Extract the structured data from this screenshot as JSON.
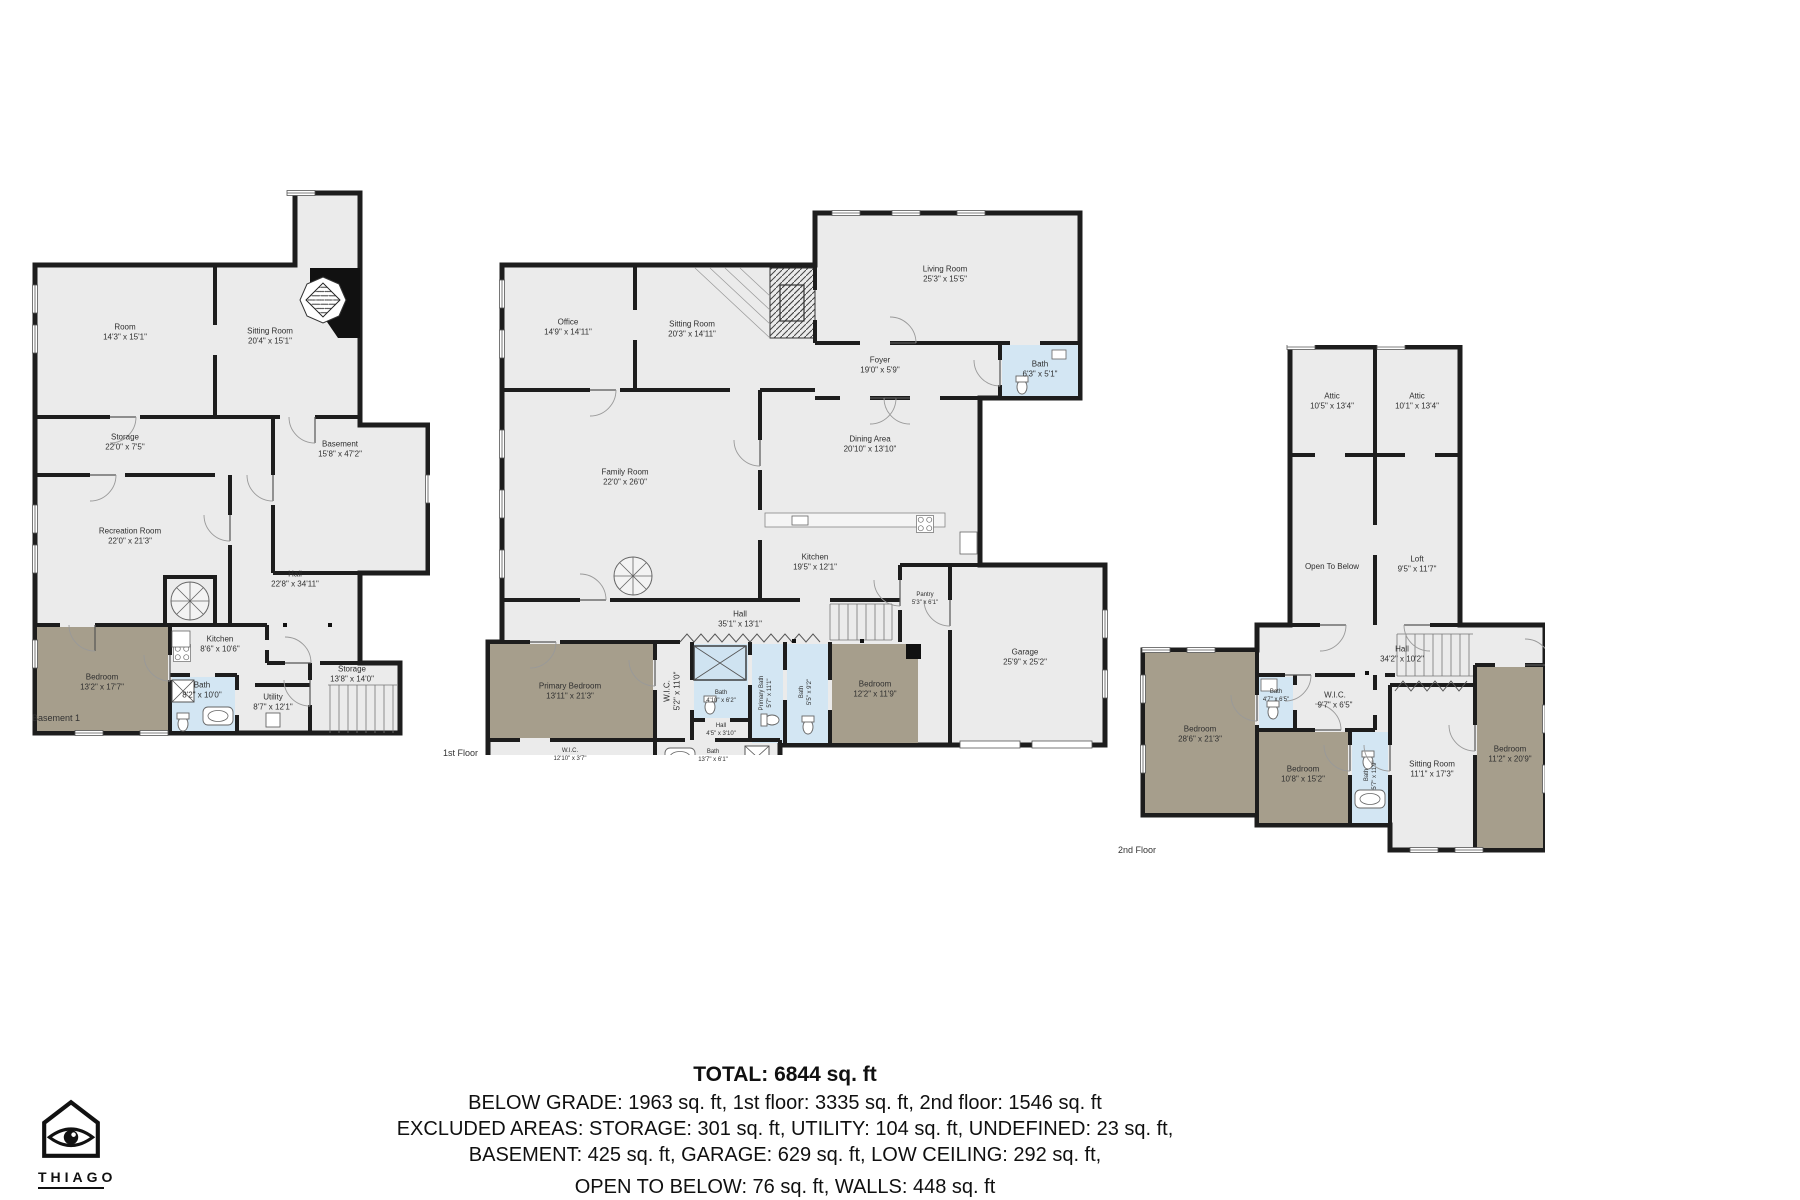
{
  "colors": {
    "floor": "#ebebeb",
    "wall": "#1d1d1d",
    "bedroom": "#a69e8c",
    "bath": "#d3e6f3"
  },
  "plans": [
    {
      "floor_label": "Basement 1",
      "rooms": [
        {
          "name": "Room",
          "dims": "14'3\" x 15'1\""
        },
        {
          "name": "Sitting Room",
          "dims": "20'4\" x 15'1\""
        },
        {
          "name": "Storage",
          "dims": "22'0\" x 7'5\""
        },
        {
          "name": "Basement",
          "dims": "15'8\" x 47'2\""
        },
        {
          "name": "Recreation Room",
          "dims": "22'0\" x 21'3\""
        },
        {
          "name": "Hall",
          "dims": "22'8\" x 34'11\""
        },
        {
          "name": "Bedroom",
          "dims": "13'2\" x 17'7\""
        },
        {
          "name": "Kitchen",
          "dims": "8'6\" x 10'6\""
        },
        {
          "name": "Bath",
          "dims": "8'2\" x 10'0\""
        },
        {
          "name": "Utility",
          "dims": "8'7\" x 12'1\""
        },
        {
          "name": "Storage",
          "dims": "13'8\" x 14'0\""
        }
      ]
    },
    {
      "floor_label": "1st Floor",
      "rooms": [
        {
          "name": "Office",
          "dims": "14'9\" x 14'11\""
        },
        {
          "name": "Sitting Room",
          "dims": "20'3\" x 14'11\""
        },
        {
          "name": "Living Room",
          "dims": "25'3\" x 15'5\""
        },
        {
          "name": "Foyer",
          "dims": "19'0\" x 5'9\""
        },
        {
          "name": "Bath",
          "dims": "6'3\" x 5'1\""
        },
        {
          "name": "Family Room",
          "dims": "22'0\" x 26'0\""
        },
        {
          "name": "Dining Area",
          "dims": "20'10\" x 13'10\""
        },
        {
          "name": "Kitchen",
          "dims": "19'5\" x 12'1\""
        },
        {
          "name": "Hall",
          "dims": "35'1\" x 13'1\""
        },
        {
          "name": "Pantry",
          "dims": "5'3\" x 6'1\""
        },
        {
          "name": "Primary Bedroom",
          "dims": "13'11\" x 21'3\""
        },
        {
          "name": "W.I.C.",
          "dims": "5'2\" x 11'0\""
        },
        {
          "name": "Bath",
          "dims": "4'10\" x 6'2\""
        },
        {
          "name": "Bath",
          "dims": "5'5\" x 9'2\""
        },
        {
          "name": "Hall",
          "dims": "4'5\" x 3'10\""
        },
        {
          "name": "Primary Bath",
          "dims": "5'7\" x 11'1\""
        },
        {
          "name": "W.I.C.",
          "dims": "12'10\" x 3'7\""
        },
        {
          "name": "Bath",
          "dims": "13'7\" x 6'1\""
        },
        {
          "name": "Bedroom",
          "dims": "12'2\" x 11'9\""
        },
        {
          "name": "Garage",
          "dims": "25'9\" x 25'2\""
        }
      ]
    },
    {
      "floor_label": "2n‌d Floor",
      "rooms": [
        {
          "name": "Attic",
          "dims": "10'5\" x 13'4\""
        },
        {
          "name": "Attic",
          "dims": "10'1\" x 13'4\""
        },
        {
          "name": "Open To Below",
          "dims": ""
        },
        {
          "name": "Loft",
          "dims": "9'5\" x 11'7\""
        },
        {
          "name": "Hall",
          "dims": "34'2\" x 10'2\""
        },
        {
          "name": "Bedroom",
          "dims": "28'6\" x 21'3\""
        },
        {
          "name": "Bath",
          "dims": "4'7\" x 6'5\""
        },
        {
          "name": "W.I.C.",
          "dims": "9'7\" x 6'5\""
        },
        {
          "name": "Bedroom",
          "dims": "10'8\" x 15'2\""
        },
        {
          "name": "Bath",
          "dims": "5'7\" x 11'9\""
        },
        {
          "name": "Sitting Room",
          "dims": "11'1\" x 17'3\""
        },
        {
          "name": "Bedroom",
          "dims": "11'2\" x 20'9\""
        }
      ]
    }
  ],
  "summary": {
    "total": "TOTAL: 6844 sq. ft",
    "line1": "BELOW GRADE: 1963 sq. ft, 1st floor: 3335 sq. ft, 2nd floor: 1546 sq. ft",
    "line2": "EXCLUDED AREAS: STORAGE: 301 sq. ft, UTILITY: 104 sq. ft, UNDEFINED: 23 sq. ft,",
    "line3": "BASEMENT: 425 sq. ft, GARAGE: 629 sq. ft, LOW CEILING: 292 sq. ft,",
    "line4": "OPEN TO BELOW: 76 sq. ft, WALLS: 448 sq. ft"
  },
  "logo": {
    "brand": "THIAGO"
  }
}
